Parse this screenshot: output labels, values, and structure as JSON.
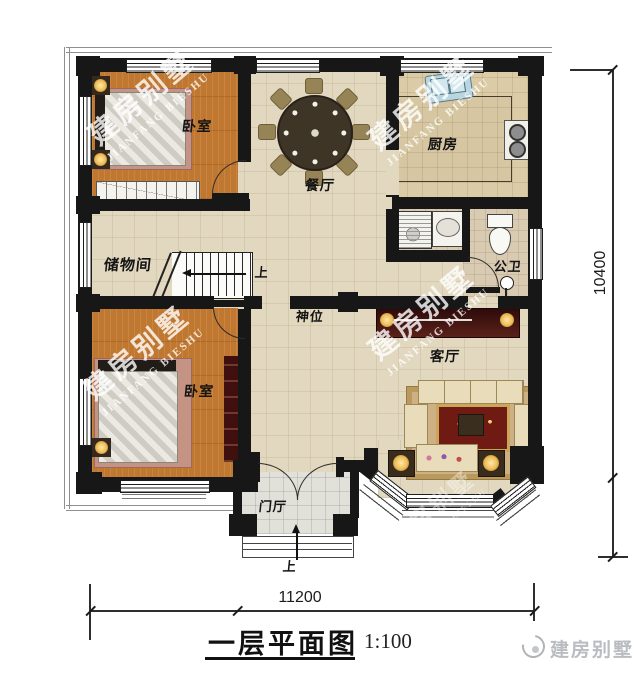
{
  "watermark": {
    "cn": "建房别墅",
    "en": "JIANFANG BIESHU"
  },
  "rooms": {
    "bedroom_top": "卧室",
    "bedroom_bottom": "卧室",
    "dining": "餐厅",
    "kitchen": "厨房",
    "storage": "储物间",
    "shrine": "神位",
    "living": "客厅",
    "bathroom": "公卫",
    "foyer": "门厅"
  },
  "stairs": {
    "up_label": "上"
  },
  "entry": {
    "up_label": "上"
  },
  "dimensions": {
    "bottom": "11200",
    "right": "10400"
  },
  "title": {
    "text": "一层平面图",
    "scale": "1:100"
  },
  "brand": {
    "logo_text": "建房别墅"
  },
  "colors": {
    "wall": "#171717",
    "wood_floor": "#c0772f",
    "tile_floor": "#e2d8bf",
    "accent_red": "#3f100d"
  }
}
